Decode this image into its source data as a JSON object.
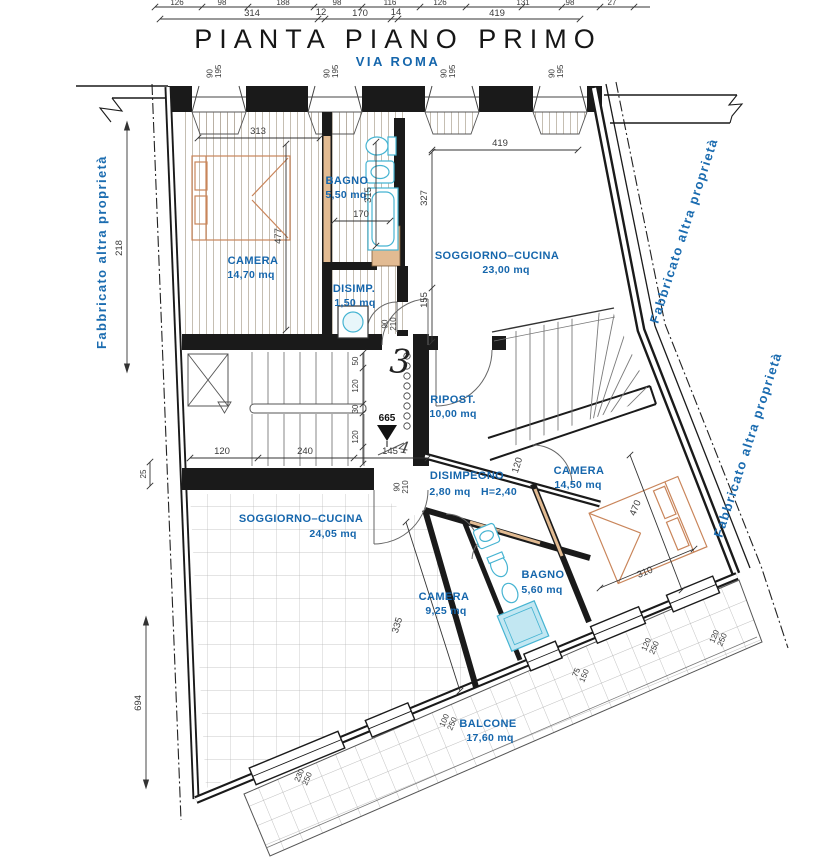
{
  "title": "PIANTA PIANO PRIMO",
  "street": "VIA ROMA",
  "boundaries": {
    "left": "Fabbricato altra proprietà",
    "upper_right": "Fabbricato altra proprietà",
    "lower_right": "Fabbricato altra proprietà"
  },
  "rooms": {
    "camera_nw": {
      "name": "CAMERA",
      "area": "14,70 mq"
    },
    "bagno_n": {
      "name": "BAGNO",
      "area": "5,50 mq"
    },
    "disimp_n": {
      "name": "DISIMP.",
      "area": "1,50 mq"
    },
    "soggiorno_ne": {
      "name": "SOGGIORNO–CUCINA",
      "area": "23,00 mq"
    },
    "ripostiglio": {
      "name": "RIPOST.",
      "area": "10,00 mq"
    },
    "disimpegno": {
      "name": "DISIMPEGNO",
      "area": "2,80 mq",
      "note": "H=2,40"
    },
    "camera_se": {
      "name": "CAMERA",
      "area": "14,50 mq"
    },
    "soggiorno_sw": {
      "name": "SOGGIORNO–CUCINA",
      "area": "24,05 mq"
    },
    "camera_s": {
      "name": "CAMERA",
      "area": "9,25 mq"
    },
    "bagno_s": {
      "name": "BAGNO",
      "area": "5,60 mq"
    },
    "balcone": {
      "name": "BALCONE",
      "area": "17,60 mq"
    }
  },
  "dims": {
    "upper_row": [
      "126",
      "98",
      "188",
      "98",
      "116",
      "126",
      "131",
      "98",
      "27"
    ],
    "lower_row": [
      "314",
      "12",
      "170",
      "14",
      "419"
    ],
    "interior": {
      "d313": "313",
      "d477": "477",
      "d218": "218",
      "d694": "694",
      "d25": "25",
      "d327": "327",
      "d155": "155",
      "d419": "419",
      "d315": "315",
      "d170": "170",
      "d335": "335",
      "d120door": "120",
      "d470": "470",
      "d310": "310"
    },
    "stair_bottom": [
      "120",
      "240",
      "145"
    ],
    "stair_right": [
      "50",
      "120",
      "30",
      "120"
    ]
  },
  "openings": {
    "street_window": {
      "w": "90",
      "h": "195"
    },
    "interior_door": {
      "w": "90",
      "h": "210"
    },
    "balcony": [
      {
        "w": "230",
        "h": "250"
      },
      {
        "w": "100",
        "h": "250"
      },
      {
        "w": "75",
        "h": "150"
      },
      {
        "w": "120",
        "h": "250"
      },
      {
        "w": "120",
        "h": "250"
      }
    ]
  },
  "markers": {
    "elevation": "665",
    "unit_number": "3",
    "correction": "4"
  },
  "colors": {
    "annotation_blue": "#1566ac",
    "wall_black": "#1a1a1a",
    "furniture_orange": "#c9855a",
    "fixture_blue": "#46b4d2",
    "new_wall_tan": "#e2bb92"
  }
}
